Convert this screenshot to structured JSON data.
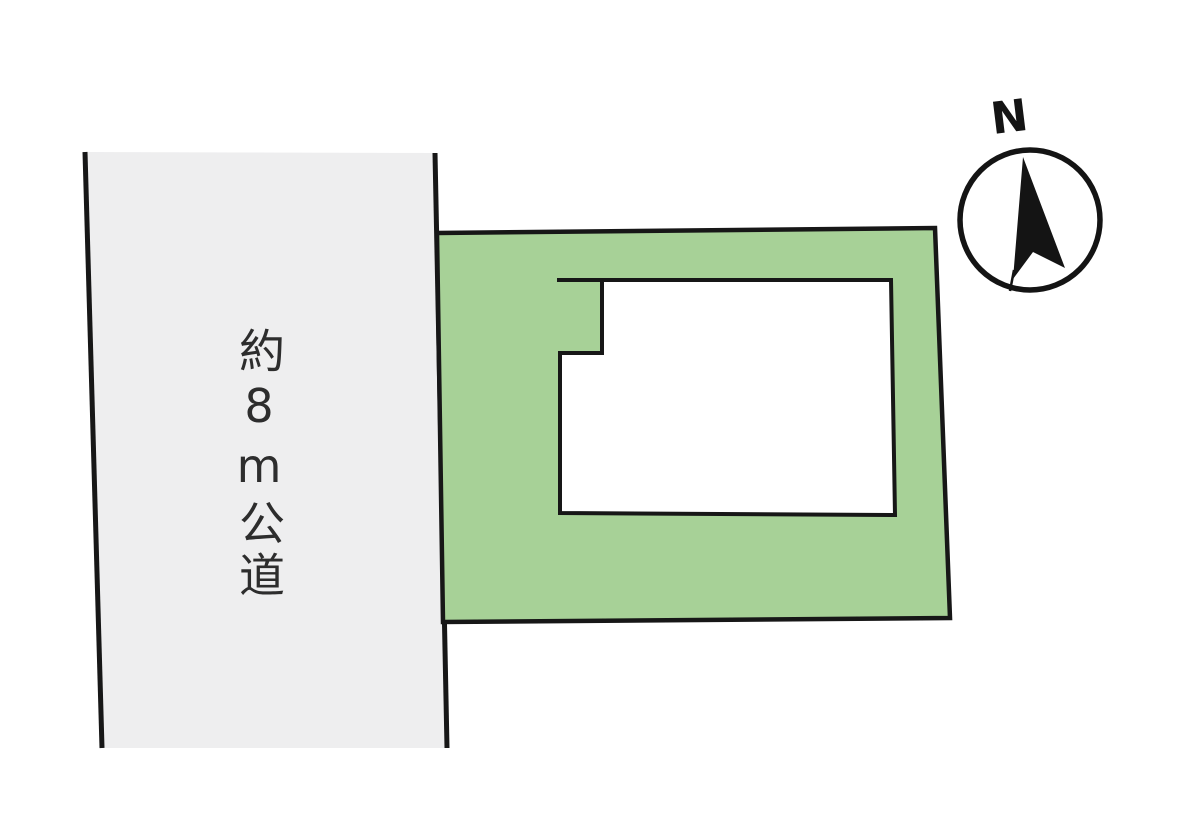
{
  "diagram": {
    "type": "real-estate-site-plan",
    "road": {
      "label": "約8m公道",
      "fill": "#eeeeef"
    },
    "plot": {
      "fill": "#a7d197"
    },
    "building": {
      "fill": "#ffffff"
    },
    "compass": {
      "label": "N"
    },
    "colors": {
      "background": "#ffffff",
      "outline": "#171717",
      "label_text": "#2d2d2d"
    }
  }
}
